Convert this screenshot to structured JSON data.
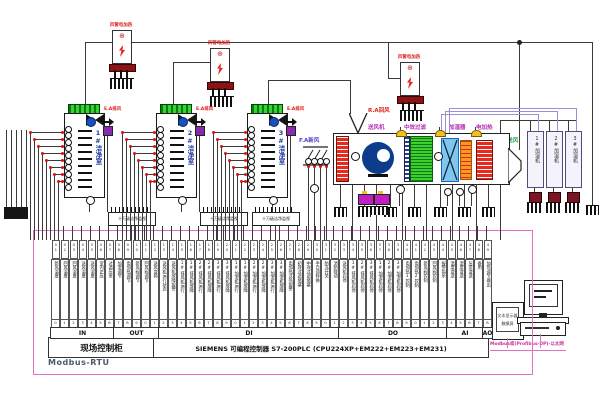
{
  "colors": {
    "wire": "#3a3a3a",
    "purple_bus": "#9b8fd8",
    "pink": "#e070c0",
    "red_label": "#e02020",
    "magenta_label": "#b32fb3",
    "green_label": "#1fa04a",
    "freshair_label": "#5a3dbb",
    "terminal_green": "#35d435",
    "heater_red": "#e32b1e",
    "filter_green": "#3ecf2a",
    "humidifier_blue": "#7fc6ee",
    "fan_blue": "#0d3c8c",
    "pump_magenta": "#c21fc2"
  },
  "top_heaters": {
    "label": "风管电加热",
    "dial_icon": "⊕"
  },
  "rooms": {
    "exhaust_label": "E.A排风",
    "names": [
      "1#洁净室",
      "2#洁净室",
      "3#洁净室"
    ],
    "monitor_label": "十万级洁净监视"
  },
  "ahu": {
    "return_air": "R.A回风",
    "fresh_air": "F.A新风",
    "supply_air": "S.A送风",
    "fan": "送风机",
    "filter": "中效过滤",
    "humidifier": "加湿器",
    "heater": "电加热"
  },
  "right_units": {
    "names": [
      "1#加湿机",
      "2#加湿机",
      "3#加湿机"
    ]
  },
  "plc": {
    "sections": [
      {
        "label": "IN",
        "cols": [
          "新风温度",
          "回风温度",
          "回风湿度",
          "送风温度",
          "送风湿度",
          "室内正压",
          "过滤压差"
        ]
      },
      {
        "label": "OUT",
        "cols": [
          "加湿调节",
          "电加热调节",
          "新风阀调节",
          "回风阀调节",
          "送风变频"
        ]
      },
      {
        "label": "DI",
        "cols": [
          "送风机运行状态",
          "送风机故障报警",
          "1#排风机运行",
          "1#排风机故障",
          "2#排风机运行",
          "2#排风机故障",
          "3#排风机运行",
          "3#排风机故障",
          "1#加湿机运行",
          "1#加湿机故障",
          "2#加湿机运行",
          "2#加湿机故障",
          "3#加湿机运行",
          "3#加湿机故障",
          "电加热过热报警",
          "初效过滤堵塞",
          "中效过滤堵塞",
          "手自动转换",
          "防冻开关",
          "消防联动"
        ]
      },
      {
        "label": "DO",
        "cols": [
          "送风机启停",
          "1#排风机启停",
          "2#排风机启停",
          "3#排风机启停",
          "1#加湿机启停",
          "2#加湿机启停",
          "3#加湿机启停",
          "电加热1控制",
          "电加热2控制",
          "新风阀控制",
          "回风阀控制",
          "报警指示"
        ]
      },
      {
        "label": "AI",
        "cols": [
          "温度变送",
          "湿度变送",
          "压差变送",
          "备用"
        ]
      },
      {
        "label": "AO",
        "cols": [
          "加热调节输出"
        ]
      }
    ],
    "cabinet_label": "现场控制柜",
    "plc_label": "SIEMENS   可编程控制器 S7-200PLC (CPU224XP+EM222+EM223+EM231)"
  },
  "comms": {
    "modbus_rtu": "Modbus-RTU",
    "ppi": "PPI(MPI)",
    "uplink": "Modbus或(Profibus-DP)-以太网"
  },
  "hmi": {
    "display_lines": [
      "文本显示器",
      "触摸屏"
    ]
  }
}
